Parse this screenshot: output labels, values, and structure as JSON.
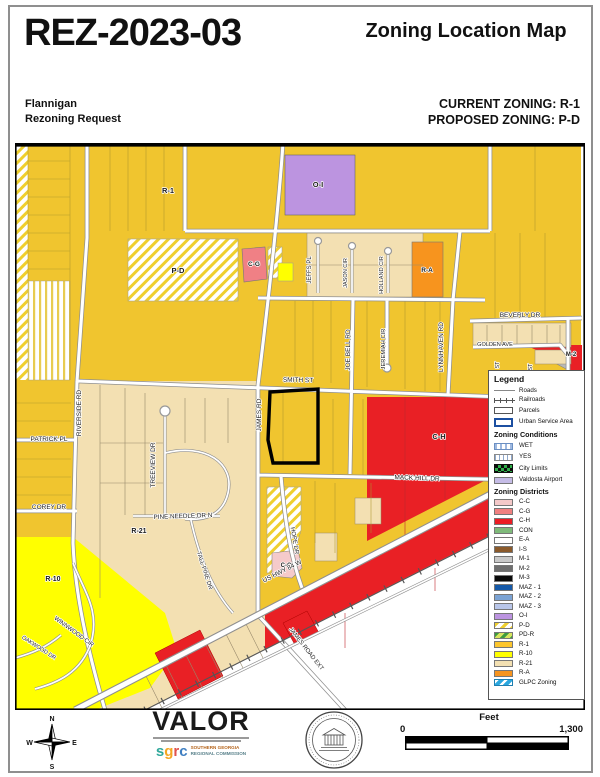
{
  "header": {
    "case_number": "REZ-2023-03",
    "map_title": "Zoning Location Map",
    "applicant_name": "Flannigan",
    "request_type": "Rezoning Request",
    "current_zoning_label": "CURRENT ZONING: R-1",
    "proposed_zoning_label": "PROPOSED ZONING: P-D"
  },
  "palette": {
    "r1": "#F0C52F",
    "r10": "#FFFF00",
    "r21": "#F3E0B2",
    "ra": "#F7941E",
    "ch": "#E92025",
    "cg": "#F08085",
    "cc": "#F5CACA",
    "oi": "#BC94E0",
    "pd_stripe": "#EFCF2E",
    "road_casing": "#8F8F8F",
    "gold_line": "#AD982F",
    "tan_line": "#97896B"
  },
  "map": {
    "labels": [
      {
        "text": "R-1",
        "x": 153,
        "y": 50,
        "size": 7.5,
        "bold": true
      },
      {
        "text": "O-I",
        "x": 303,
        "y": 44,
        "size": 7.5,
        "bold": true
      },
      {
        "text": "P-D",
        "x": 163,
        "y": 130,
        "size": 7.5,
        "bold": true
      },
      {
        "text": "C-G",
        "x": 239,
        "y": 123,
        "size": 6.5,
        "bold": true
      },
      {
        "text": "R-A",
        "x": 412,
        "y": 129,
        "size": 6.5,
        "bold": true
      },
      {
        "text": "C-H",
        "x": 424,
        "y": 296,
        "size": 7.5,
        "bold": true
      },
      {
        "text": "R-21",
        "x": 124,
        "y": 390,
        "size": 7,
        "bold": true
      },
      {
        "text": "R-10",
        "x": 38,
        "y": 438,
        "size": 7,
        "bold": true
      },
      {
        "text": "C-C",
        "x": 271,
        "y": 424,
        "size": 6,
        "bold": true
      },
      {
        "text": "M-2",
        "x": 556,
        "y": 213,
        "size": 6,
        "bold": true
      },
      {
        "text": "SMITH ST",
        "x": 283,
        "y": 239,
        "size": 6.5,
        "rot": 1
      },
      {
        "text": "JAMES RD",
        "x": 246,
        "y": 272,
        "size": 6.5,
        "rot": -90
      },
      {
        "text": "JOE BELL RD",
        "x": 335,
        "y": 207,
        "size": 6.5,
        "rot": -90
      },
      {
        "text": "JEREMIAH CIR",
        "x": 370,
        "y": 206,
        "size": 5.8,
        "rot": -90
      },
      {
        "text": "LYNNHAVEN RD",
        "x": 428,
        "y": 204,
        "size": 6.5,
        "rot": -90
      },
      {
        "text": "ST",
        "x": 484,
        "y": 222,
        "size": 5.5,
        "rot": -90
      },
      {
        "text": "ST",
        "x": 517,
        "y": 224,
        "size": 5.5,
        "rot": -90
      },
      {
        "text": "JEFFS PL",
        "x": 296,
        "y": 127,
        "size": 6,
        "rot": -90
      },
      {
        "text": "JASON CIR",
        "x": 332,
        "y": 130,
        "size": 5.6,
        "rot": -90
      },
      {
        "text": "HOLLAND CIR",
        "x": 368,
        "y": 132,
        "size": 5.6,
        "rot": -90
      },
      {
        "text": "BEVERLY DR",
        "x": 505,
        "y": 174,
        "size": 6.5
      },
      {
        "text": "GOLDEN AVE",
        "x": 480,
        "y": 203,
        "size": 5.6
      },
      {
        "text": "MACK HILL DR",
        "x": 402,
        "y": 337,
        "size": 6.5,
        "rot": 2
      },
      {
        "text": "PATRICK PL",
        "x": 34,
        "y": 298,
        "size": 6.5
      },
      {
        "text": "RIVERSIDE RD",
        "x": 66,
        "y": 270,
        "size": 6.5,
        "rot": -90
      },
      {
        "text": "TREEVIEW DR",
        "x": 140,
        "y": 322,
        "size": 6.5,
        "rot": -90
      },
      {
        "text": "COREY DR",
        "x": 34,
        "y": 366,
        "size": 6.5
      },
      {
        "text": "PINE NEEDLE DR N",
        "x": 168,
        "y": 375,
        "size": 6.3,
        "rot": -2
      },
      {
        "text": "TALL PINE DR",
        "x": 188,
        "y": 428,
        "size": 6,
        "rot": 72
      },
      {
        "text": "HOPE DR",
        "x": 278,
        "y": 398,
        "size": 6,
        "rot": 80
      },
      {
        "text": "US HWY 84 W",
        "x": 268,
        "y": 430,
        "size": 6.5,
        "rot": -27
      },
      {
        "text": "WINNWOOD CIR",
        "x": 58,
        "y": 490,
        "size": 6,
        "rot": 36
      },
      {
        "text": "OAKWOOD DR",
        "x": 23,
        "y": 506,
        "size": 5.6,
        "rot": 33
      },
      {
        "text": "JAMES ROAD EXT",
        "x": 290,
        "y": 507,
        "size": 6,
        "rot": 52
      }
    ]
  },
  "legend": {
    "title": "Legend",
    "base": [
      {
        "label": "Roads"
      },
      {
        "label": "Railroads"
      },
      {
        "label": "Parcels"
      },
      {
        "label": "Urban Service Area"
      }
    ],
    "conditions_title": "Zoning Conditions",
    "conditions": [
      {
        "label": "WET"
      },
      {
        "label": "YES"
      },
      {
        "label": "City Limits"
      },
      {
        "label": "Valdosta Airport",
        "color": "#C5BCE6"
      }
    ],
    "districts_title": "Zoning Districts",
    "districts": [
      {
        "label": "C-C",
        "color": "#F4C9C9"
      },
      {
        "label": "C-G",
        "color": "#F08080"
      },
      {
        "label": "C-H",
        "color": "#EC1C24"
      },
      {
        "label": "CON",
        "color": "#7FBA7A"
      },
      {
        "label": "E-A",
        "color": "#FFFFFF"
      },
      {
        "label": "I-S",
        "color": "#8B5A2B"
      },
      {
        "label": "M-1",
        "color": "#C9C9C9"
      },
      {
        "label": "M-2",
        "color": "#6E6E6E"
      },
      {
        "label": "M-3",
        "color": "#0A0A0A"
      },
      {
        "label": "MAZ - 1",
        "color": "#1559A8"
      },
      {
        "label": "MAZ - 2",
        "color": "#7BA3D4"
      },
      {
        "label": "MAZ - 3",
        "color": "#B9C6E9"
      },
      {
        "label": "O-I",
        "color": "#BC94E0"
      },
      {
        "label": "P-D",
        "pattern": "pd"
      },
      {
        "label": "PD-R",
        "pattern": "pdr"
      },
      {
        "label": "R-1",
        "color": "#FCC62D"
      },
      {
        "label": "R-10",
        "color": "#FFFF00"
      },
      {
        "label": "R-21",
        "color": "#F3E0B2"
      },
      {
        "label": "R-A",
        "color": "#F7941E"
      },
      {
        "label": "GLPC Zoning",
        "pattern": "glpc"
      }
    ]
  },
  "footer": {
    "compass": {
      "n": "N",
      "e": "E",
      "s": "S",
      "w": "W"
    },
    "credits": {
      "valor": "VALOR",
      "sgrc": "sgrc",
      "org_line1": "SOUTHERN GEORGIA",
      "org_line2": "REGIONAL COMMISSION"
    },
    "scalebar": {
      "units": "Feet",
      "min": "0",
      "max": "1,300"
    }
  }
}
